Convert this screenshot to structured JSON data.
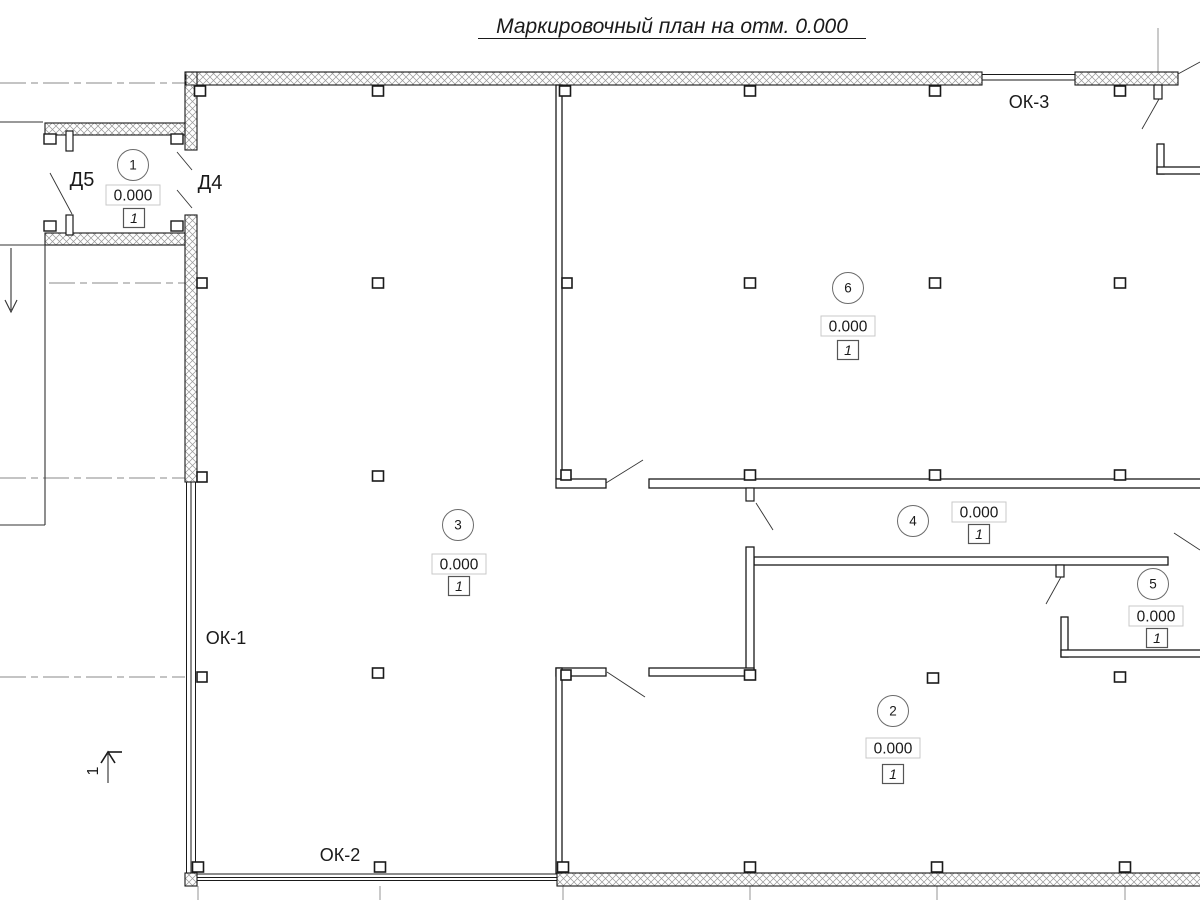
{
  "title": "Маркировочный план на отм. 0.000",
  "section_mark": {
    "label": "1"
  },
  "colors": {
    "ink": "#1a1a1a",
    "hatch": "#9a9a9a",
    "marker_box_border": "#c9c9c9",
    "circle_border": "#6b6b6b",
    "axis_line": "#8a8a8a"
  },
  "rooms": [
    {
      "number": "1",
      "elevation": "0.000",
      "floor_type": "1",
      "circle": {
        "x": 133,
        "y": 165
      },
      "elev_box": {
        "x": 133,
        "y": 195
      },
      "type_box": {
        "x": 134,
        "y": 218
      }
    },
    {
      "number": "2",
      "elevation": "0.000",
      "floor_type": "1",
      "circle": {
        "x": 893,
        "y": 711
      },
      "elev_box": {
        "x": 893,
        "y": 748
      },
      "type_box": {
        "x": 893,
        "y": 774
      }
    },
    {
      "number": "3",
      "elevation": "0.000",
      "floor_type": "1",
      "circle": {
        "x": 458,
        "y": 525
      },
      "elev_box": {
        "x": 459,
        "y": 564
      },
      "type_box": {
        "x": 459,
        "y": 586
      }
    },
    {
      "number": "4",
      "elevation": "0.000",
      "floor_type": "1",
      "circle": {
        "x": 913,
        "y": 521
      },
      "elev_box": {
        "x": 979,
        "y": 512
      },
      "type_box": {
        "x": 979,
        "y": 534
      }
    },
    {
      "number": "5",
      "elevation": "0.000",
      "floor_type": "1",
      "circle": {
        "x": 1153,
        "y": 584
      },
      "elev_box": {
        "x": 1156,
        "y": 616
      },
      "type_box": {
        "x": 1157,
        "y": 638
      }
    },
    {
      "number": "6",
      "elevation": "0.000",
      "floor_type": "1",
      "circle": {
        "x": 848,
        "y": 288
      },
      "elev_box": {
        "x": 848,
        "y": 326
      },
      "type_box": {
        "x": 848,
        "y": 350
      }
    }
  ],
  "door_labels": [
    {
      "text": "Д5",
      "x": 82,
      "y": 186
    },
    {
      "text": "Д4",
      "x": 210,
      "y": 189
    }
  ],
  "window_labels": [
    {
      "text": "ОК-1",
      "x": 226,
      "y": 644
    },
    {
      "text": "ОК-2",
      "x": 340,
      "y": 861
    },
    {
      "text": "ОК-3",
      "x": 1029,
      "y": 108
    }
  ]
}
